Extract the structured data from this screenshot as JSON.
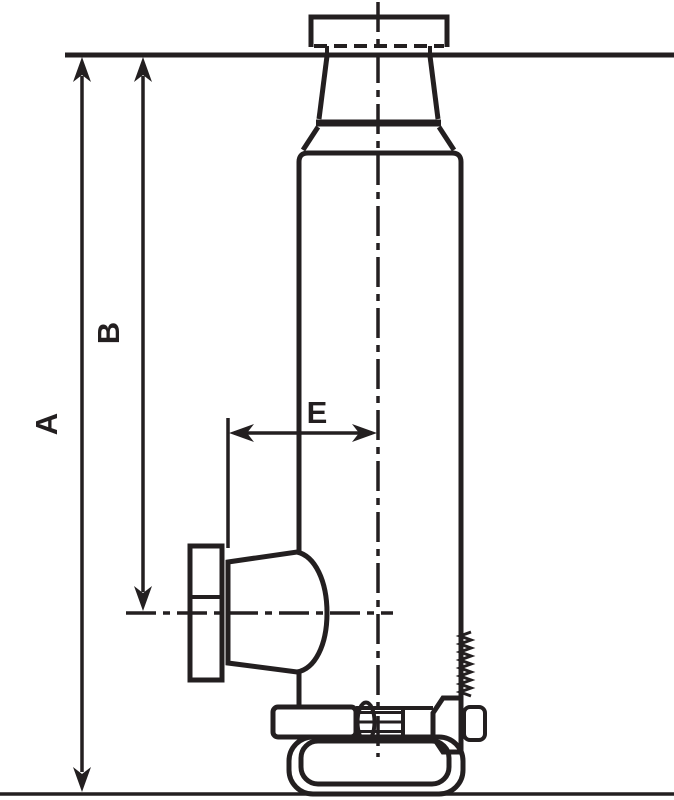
{
  "drawing": {
    "title": "Bottle jack dimensional line drawing",
    "labels": {
      "dim_a": "A",
      "dim_b": "B",
      "dim_e": "E"
    },
    "colors": {
      "line": "#231f20",
      "background": "#ffffff"
    },
    "parts": [
      "saddle-cap",
      "extended-ram",
      "cylinder-body",
      "pump-bell",
      "lever-sleeve",
      "release-valve",
      "return-spring",
      "base"
    ]
  }
}
